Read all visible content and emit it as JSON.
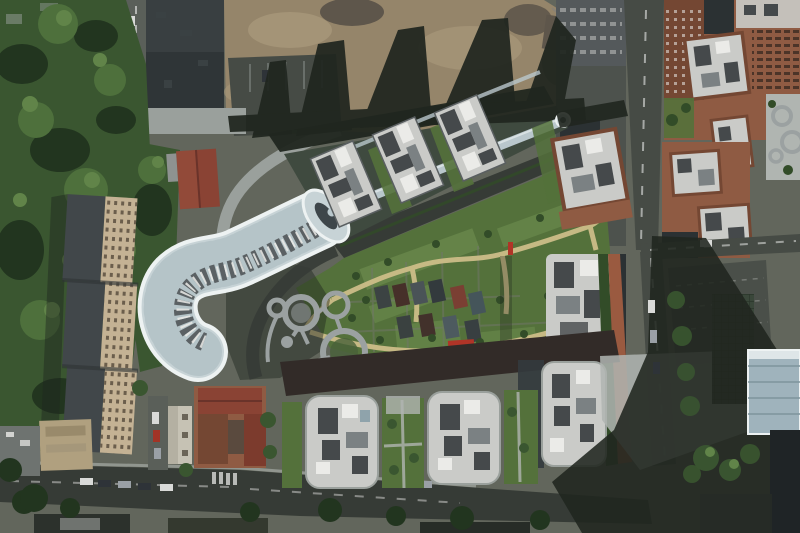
{
  "meta": {
    "type": "aerial photograph",
    "description": "Aerial top-down view of an urban residential complex: an S-shaped white-roofed building, landscaped courtyard with yellow paths and circular plazas, rows of angled tower blocks, square residential towers, brick buildings, a demolition site with long shadows, tree masses and roads with parked cars.",
    "width": 800,
    "height": 533
  },
  "landmarks": [
    "s-curve-building",
    "glass-walkway",
    "angled-tower-row",
    "courtyard-garden",
    "circle-plaza",
    "residential-towers",
    "brick-complex",
    "demolition-site",
    "slab-building",
    "tree-canopy",
    "perimeter-roads"
  ],
  "colors": {
    "base": "#62665c",
    "treeDark": "#22351f",
    "treeMid": "#3a5630",
    "treeLight": "#4e703c",
    "treeHi": "#618449",
    "lawn": "#54713b",
    "lawnLight": "#6c8c4e",
    "hedge": "#324c28",
    "dirt": "#95856a",
    "dirtLight": "#a8977a",
    "rubble": "#5e564b",
    "shadow": "#20261f",
    "asphalt": "#464b45",
    "asphaltLight": "#5a5f59",
    "roadDark": "#363b36",
    "ground2": "#4d524d",
    "plaza": "#9aa09c",
    "pavement": "#b0b5b1",
    "curveRoof": "#c7d3d6",
    "curveRim": "#edf2f2",
    "curveRib": "#9fb2b8",
    "glassStrip": "#b9c7cc",
    "skylight": "#3e464a",
    "roofWhite": "#cacbc8",
    "roofClutter": "#45494b",
    "unitWhite": "#ebebe8",
    "roofGrey": "#7b8183",
    "brick": "#8f5b43",
    "brickDark": "#744733",
    "brickPath": "#9a5a40",
    "redRoof": "#8a4334",
    "redBright": "#b03427",
    "slabRoof": "#41474a",
    "slabFacade": "#c4b294",
    "slabWin": "#6b5e4c",
    "pathYellow": "#cdbd88",
    "circleGrey": "#9ba1a1",
    "darkRoof": "#2b3133",
    "darkBldg": "#333a3d",
    "bandDark": "#322b28",
    "clusterDark": "#272d30",
    "blueBldg": "#9fb3bc",
    "blueLine": "#7e949c",
    "meshBldg": "#3a473a",
    "white": "#eef0ef",
    "carWhite": "#d9dad8",
    "carSilver": "#9aa0a6",
    "carDark": "#2e3338",
    "carRed": "#a23426",
    "steel": "#54595b"
  }
}
